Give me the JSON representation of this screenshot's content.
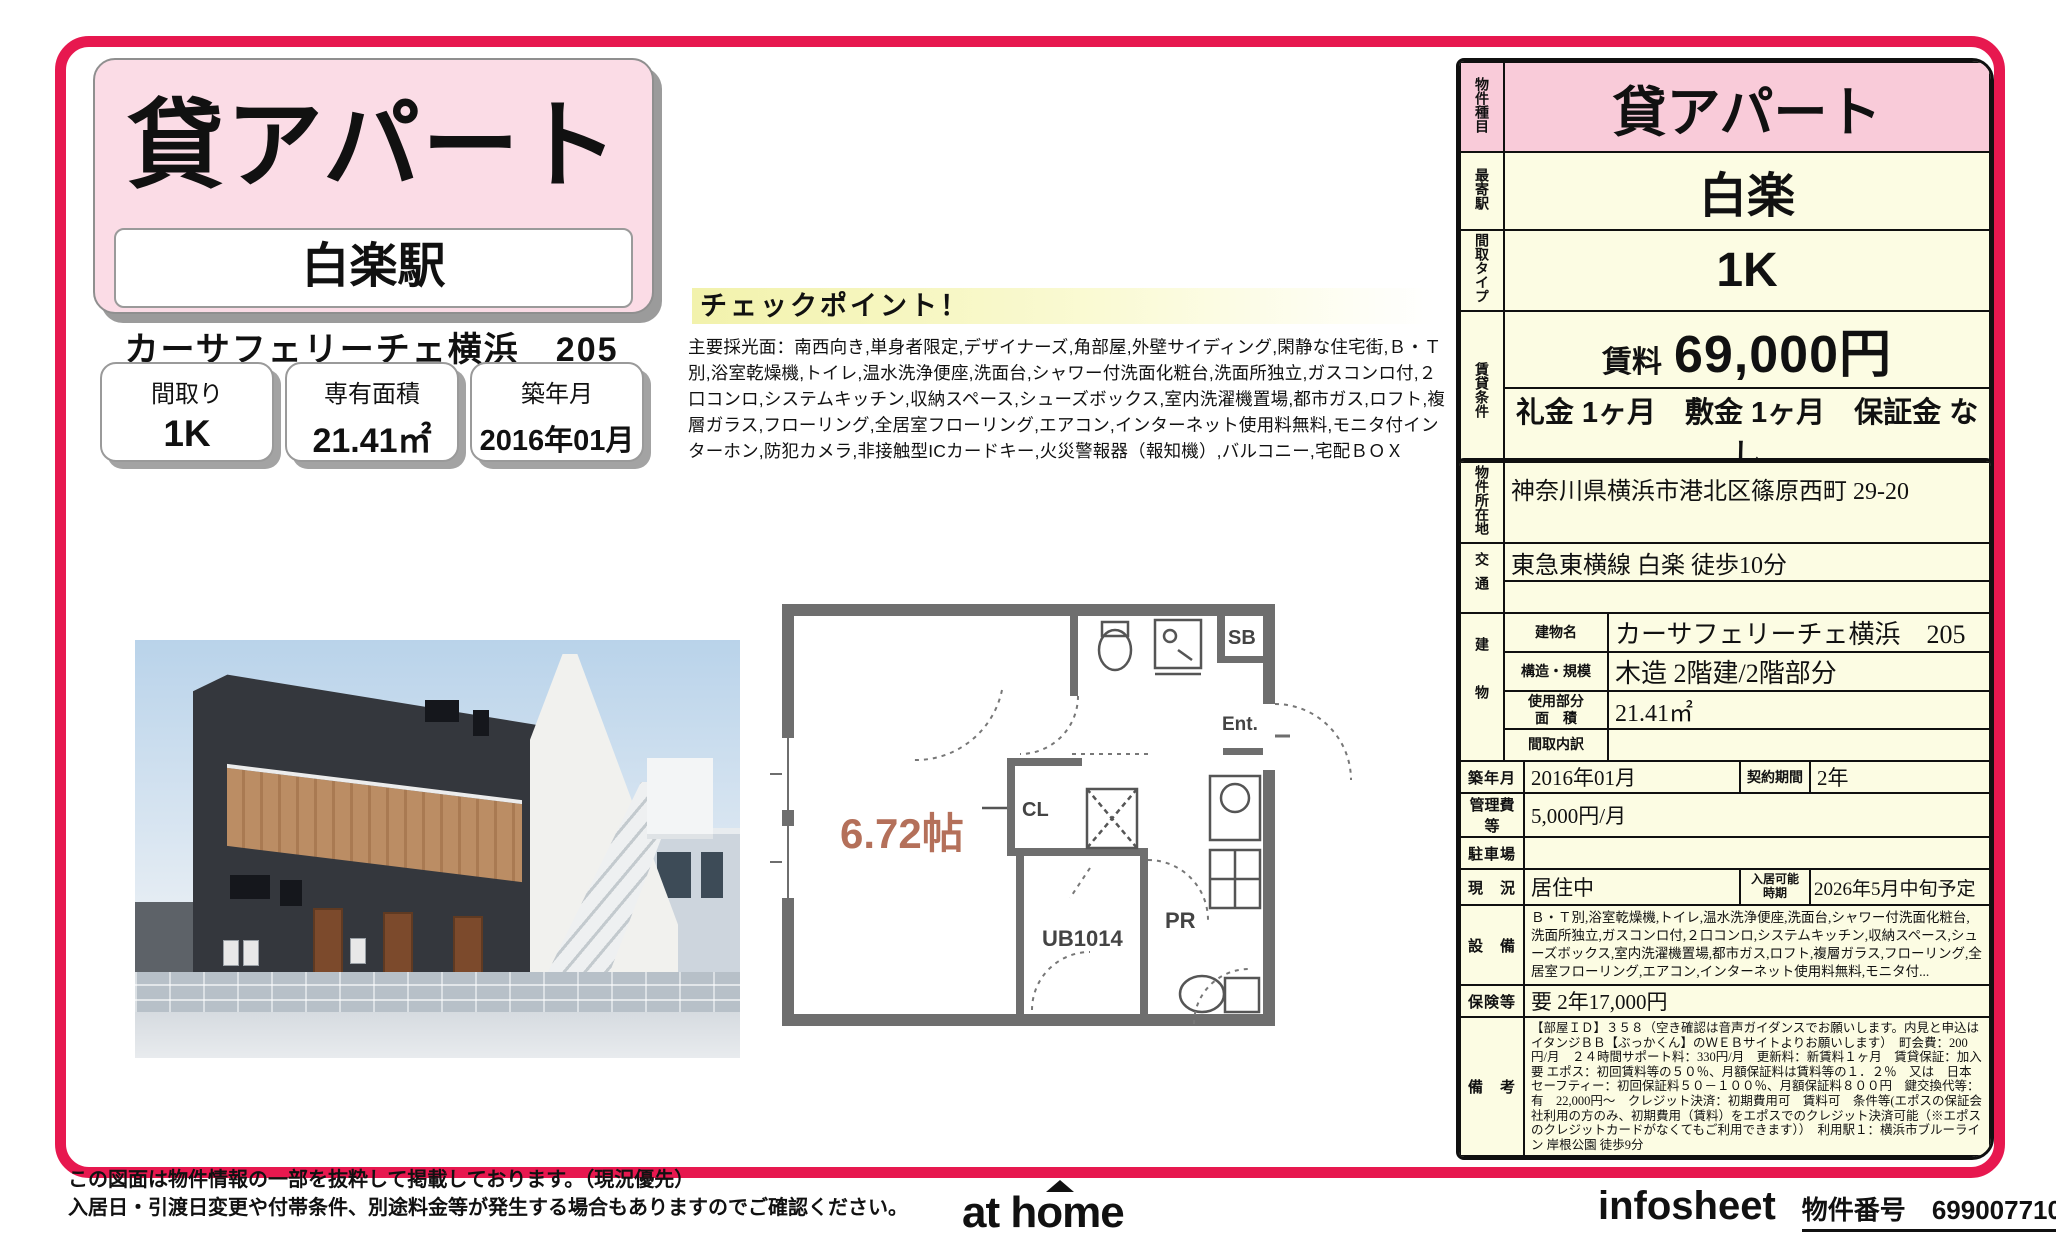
{
  "header": {
    "title": "貸アパート",
    "station": "白楽駅",
    "property_name": "カーサフェリーチェ横浜　205"
  },
  "summary_boxes": [
    {
      "label": "間取り",
      "value": "1K"
    },
    {
      "label": "専有面積",
      "value": "21.41㎡"
    },
    {
      "label": "築年月",
      "value": "2016年01月"
    }
  ],
  "checkpoint": {
    "title": "チェックポイント！",
    "body": "主要採光面：南西向き,単身者限定,デザイナーズ,角部屋,外壁サイディング,閑静な住宅街,Ｂ・Ｔ別,浴室乾燥機,トイレ,温水洗浄便座,洗面台,シャワー付洗面化粧台,洗面所独立,ガスコンロ付,２口コンロ,システムキッチン,収納スペース,シューズボックス,室内洗濯機置場,都市ガス,ロフト,複層ガラス,フローリング,全居室フローリング,エアコン,インターネット使用料無料,モニタ付インターホン,防犯カメラ,非接触型ICカードキー,火災警報器（報知機）,バルコニー,宅配ＢＯＸ"
  },
  "floor_plan": {
    "room_size": "6.72帖",
    "closet": "CL",
    "bath": "UB1014",
    "powder_room": "PR",
    "shoe_box": "SB",
    "entrance": "Ent."
  },
  "spec_table": {
    "type_label": "物件種目",
    "type_value": "貸アパート",
    "station_label": "最寄駅",
    "station_value": "白楽",
    "layout_label": "間取タイプ",
    "layout_value": "1K",
    "terms_label": "賃貸条件",
    "rent_label": "賃料",
    "rent_value": "69,000円",
    "terms_value": "礼金 1ヶ月　敷金 1ヶ月　保証金 なし"
  },
  "detail_table": {
    "address_label": "物件所在地",
    "address_value": "神奈川県横浜市港北区篠原西町 29-20",
    "traffic_label": "交通",
    "traffic_value": "東急東横線 白楽 徒歩10分",
    "traffic_value2": "",
    "building_label": "建物",
    "bname_label": "建物名",
    "bname_value": "カーサフェリーチェ横浜　205",
    "structure_label": "構造・規模",
    "structure_value": "木造 2階建/2階部分",
    "area_label_1": "使用部分",
    "area_label_2": "面　積",
    "area_value": "21.41㎡",
    "layout_detail_label": "間取内訳",
    "layout_detail_value": "",
    "built_label": "築年月",
    "built_value": "2016年01月",
    "contract_label": "契約期間",
    "contract_value": "2年",
    "fee_label": "管理費等",
    "fee_value": "5,000円/月",
    "parking_label": "駐車場",
    "parking_value": "",
    "status_label": "現　況",
    "status_value": "居住中",
    "movein_label_1": "入居可能",
    "movein_label_2": "時期",
    "movein_value": "2026年5月中旬予定",
    "equipment_label": "設　備",
    "equipment_value": "Ｂ・Ｔ別,浴室乾燥機,トイレ,温水洗浄便座,洗面台,シャワー付洗面化粧台,洗面所独立,ガスコンロ付,２口コンロ,システムキッチン,収納スペース,シューズボックス,室内洗濯機置場,都市ガス,ロフト,複層ガラス,フローリング,全居室フローリング,エアコン,インターネット使用料無料,モニタ付...",
    "insurance_label": "保険等",
    "insurance_value": "要 2年17,000円",
    "notes_label": "備　考",
    "notes_value": "【部屋ＩＤ】３５８（空き確認は音声ガイダンスでお願いします。内見と申込はイタンジＢＢ【ぶっかくん】のＷＥＢサイトよりお願いします）　町会費：200円/月　２４時間サポート料：330円/月　更新料：新賃料１ヶ月　賃貸保証：加入要 エポス：初回賃料等の５０％、月額保証料は賃料等の１．２％　又は　日本セーフティー：初回保証料５０－１００％、月額保証料８００円　鍵交換代等：有　22,000円～　クレジット決済：初期費用可　賃料可　条件等(エポスの保証会社利用の方のみ、初期費用（賃料）をエポスでのクレジット決済可能（※エポスのクレジットカードがなくてもご利用できます））　利用駅１：横浜市ブルーライン 岸根公園 徒歩9分"
  },
  "footer": {
    "note1": "この図面は物件情報の一部を抜粋して掲載しております。（現況優先）",
    "note2": "入居日・引渡日変更や付帯条件、別途料金等が発生する場合もありますのでご確認ください。",
    "logo": "at home",
    "sheet_name": "infosheet",
    "property_no_label": "物件番号",
    "property_no": "69900771035"
  },
  "colors": {
    "frame_red": "#e7184f",
    "pink": "#f9cbd9",
    "pink_light": "#fbdce6",
    "cream": "#fcfce3",
    "plan_text": "#b4705a"
  }
}
